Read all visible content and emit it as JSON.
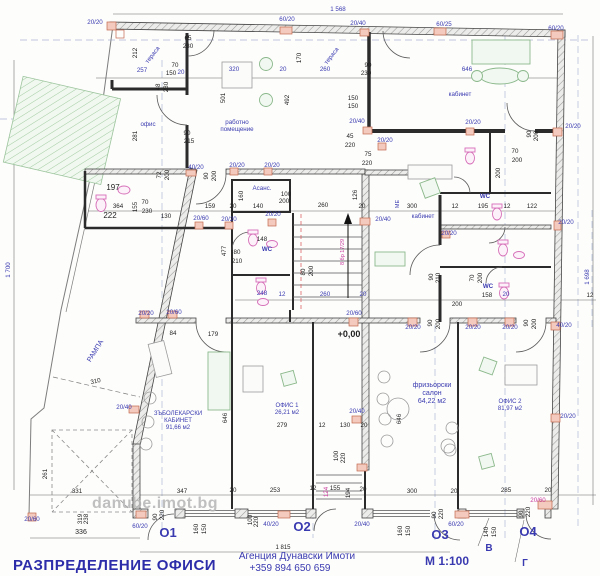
{
  "drawing": {
    "title": "РАЗПРЕДЕЛЕНИЕ ОФИСИ",
    "watermark": "danube.imot.bg",
    "agency": "Агенция Дунавски Имоти",
    "phone": "+359 894 650 659",
    "scale": "М 1:100",
    "level_mark": "+0,00",
    "stair_note": "8 бр 17/29",
    "overall_dims": {
      "top": "1 568",
      "left": "1 700",
      "right": "1 698",
      "bottom": "1 815"
    }
  },
  "axes": [
    "О1",
    "О2",
    "О3",
    "О4",
    "В",
    "Г"
  ],
  "rooms": [
    {
      "name": "тераса"
    },
    {
      "name": "офис"
    },
    {
      "name": "работно помещение"
    },
    {
      "name": "кабинет"
    },
    {
      "name": "Асанс."
    },
    {
      "name": "WC"
    },
    {
      "name": "РАМПА"
    },
    {
      "name": "ЗЪБОЛЕКАРСКИ КАБИНЕТ",
      "area": "91,66 м2"
    },
    {
      "name": "ОФИС 1",
      "area": "26,21 м2"
    },
    {
      "name": "фризьорски салон",
      "area": "64,22 м2"
    },
    {
      "name": "ОФИС 2",
      "area": "81,97 м2"
    }
  ],
  "labels": [
    {
      "t": "тераса",
      "x": 154,
      "y": 56,
      "c": "b",
      "r": -52,
      "n": "room-label-terrace-1"
    },
    {
      "t": "тераса",
      "x": 333,
      "y": 57,
      "c": "b",
      "r": -52,
      "n": "room-label-terrace-2"
    },
    {
      "t": "офис",
      "x": 148,
      "y": 126,
      "c": "b",
      "n": "room-label-office"
    },
    {
      "t": "работно",
      "x": 237,
      "y": 124,
      "c": "b",
      "n": "room-label-workroom"
    },
    {
      "t": "помещение",
      "x": 237,
      "y": 131,
      "c": "b"
    },
    {
      "t": "кабинет",
      "x": 460,
      "y": 96,
      "c": "b",
      "n": "room-label-cabinet-top"
    },
    {
      "t": "кабинет",
      "x": 423,
      "y": 218,
      "c": "b",
      "n": "room-label-cabinet-mid"
    },
    {
      "t": "Асанс.",
      "x": 262,
      "y": 190,
      "c": "b",
      "n": "room-label-elevator"
    },
    {
      "t": "WC",
      "x": 485,
      "y": 198,
      "c": "b",
      "b": 1,
      "n": "room-label-wc-1"
    },
    {
      "t": "WC",
      "x": 267,
      "y": 251,
      "c": "b",
      "b": 1,
      "n": "room-label-wc-2"
    },
    {
      "t": "WC",
      "x": 488,
      "y": 288,
      "c": "b",
      "b": 1,
      "n": "room-label-wc-3"
    },
    {
      "t": "МЕ",
      "x": 399,
      "y": 204,
      "c": "b",
      "r": -90,
      "s": 5.5
    },
    {
      "t": "РАМПА",
      "x": 97,
      "y": 352,
      "c": "b",
      "r": -58,
      "s": 7,
      "n": "room-label-ramp"
    },
    {
      "t": "ЗЪБОЛЕКАРСКИ",
      "x": 178,
      "y": 415,
      "c": "b",
      "s": 6,
      "n": "room-label-dental"
    },
    {
      "t": "КАБИНЕТ",
      "x": 178,
      "y": 422,
      "c": "b",
      "s": 6
    },
    {
      "t": "91,66 м2",
      "x": 178,
      "y": 429,
      "c": "b",
      "s": 6
    },
    {
      "t": "ОФИС 1",
      "x": 287,
      "y": 407,
      "c": "b",
      "s": 6,
      "n": "room-label-office1"
    },
    {
      "t": "26,21 м2",
      "x": 287,
      "y": 414,
      "c": "b",
      "s": 6
    },
    {
      "t": "фризьорски",
      "x": 432,
      "y": 387,
      "c": "b",
      "s": 7,
      "n": "room-label-salon"
    },
    {
      "t": "салон",
      "x": 432,
      "y": 395,
      "c": "b",
      "s": 7
    },
    {
      "t": "64,22 м2",
      "x": 432,
      "y": 403,
      "c": "b",
      "s": 7
    },
    {
      "t": "ОФИС 2",
      "x": 510,
      "y": 403,
      "c": "b",
      "s": 6,
      "n": "room-label-office2"
    },
    {
      "t": "81,97 м2",
      "x": 510,
      "y": 410,
      "c": "b",
      "s": 6
    },
    {
      "t": "О1",
      "x": 168,
      "y": 537,
      "c": "b",
      "s": 13,
      "b": 1,
      "n": "axis-label-O1"
    },
    {
      "t": "О2",
      "x": 302,
      "y": 531,
      "c": "b",
      "s": 13,
      "b": 1,
      "n": "axis-label-O2"
    },
    {
      "t": "О3",
      "x": 440,
      "y": 539,
      "c": "b",
      "s": 13,
      "b": 1,
      "n": "axis-label-O3"
    },
    {
      "t": "О4",
      "x": 528,
      "y": 536,
      "c": "b",
      "s": 13,
      "b": 1,
      "n": "axis-label-O4"
    },
    {
      "t": "В",
      "x": 489,
      "y": 551,
      "c": "b",
      "s": 10,
      "b": 1,
      "n": "axis-label-V"
    },
    {
      "t": "Г",
      "x": 525,
      "y": 566,
      "c": "b",
      "s": 10,
      "b": 1,
      "n": "axis-label-G"
    },
    {
      "t": "8 бр 17/29",
      "x": 344,
      "y": 252,
      "c": "p",
      "r": -90,
      "s": 5.5,
      "n": "stair-note"
    },
    {
      "t": "124",
      "x": 328,
      "y": 492,
      "c": "p",
      "r": -90
    },
    {
      "t": "20/60",
      "x": 538,
      "y": 502,
      "c": "p"
    },
    {
      "t": "20/20",
      "x": 95,
      "y": 24,
      "c": "b"
    },
    {
      "t": "60/20",
      "x": 287,
      "y": 21,
      "c": "b"
    },
    {
      "t": "20/40",
      "x": 358,
      "y": 25,
      "c": "b"
    },
    {
      "t": "60/25",
      "x": 444,
      "y": 26,
      "c": "b"
    },
    {
      "t": "60/20",
      "x": 556,
      "y": 30,
      "c": "b"
    },
    {
      "t": "257",
      "x": 142,
      "y": 72,
      "c": "b"
    },
    {
      "t": "20",
      "x": 181,
      "y": 74,
      "c": "b"
    },
    {
      "t": "320",
      "x": 234,
      "y": 71,
      "c": "b"
    },
    {
      "t": "20",
      "x": 283,
      "y": 71,
      "c": "b"
    },
    {
      "t": "260",
      "x": 325,
      "y": 71,
      "c": "b"
    },
    {
      "t": "646",
      "x": 467,
      "y": 71,
      "c": "b"
    },
    {
      "t": "40/20",
      "x": 196,
      "y": 169,
      "c": "b"
    },
    {
      "t": "20/20",
      "x": 237,
      "y": 167,
      "c": "b"
    },
    {
      "t": "20/20",
      "x": 272,
      "y": 167,
      "c": "b"
    },
    {
      "t": "20/40",
      "x": 357,
      "y": 123,
      "c": "b"
    },
    {
      "t": "20/20",
      "x": 473,
      "y": 124,
      "c": "b"
    },
    {
      "t": "20/20",
      "x": 573,
      "y": 128,
      "c": "b"
    },
    {
      "t": "20/20",
      "x": 385,
      "y": 142,
      "c": "b"
    },
    {
      "t": "20/20",
      "x": 273,
      "y": 216,
      "c": "b"
    },
    {
      "t": "20/60",
      "x": 201,
      "y": 220,
      "c": "b"
    },
    {
      "t": "20/20",
      "x": 229,
      "y": 221,
      "c": "b"
    },
    {
      "t": "20/40",
      "x": 383,
      "y": 221,
      "c": "b"
    },
    {
      "t": "20/20",
      "x": 449,
      "y": 235,
      "c": "b"
    },
    {
      "t": "20/20",
      "x": 566,
      "y": 224,
      "c": "b"
    },
    {
      "t": "248",
      "x": 262,
      "y": 295,
      "c": "b"
    },
    {
      "t": "12",
      "x": 282,
      "y": 296,
      "c": "b"
    },
    {
      "t": "260",
      "x": 325,
      "y": 296,
      "c": "b"
    },
    {
      "t": "20",
      "x": 363,
      "y": 296,
      "c": "b"
    },
    {
      "t": "20",
      "x": 506,
      "y": 296,
      "c": "b"
    },
    {
      "t": "20/60",
      "x": 354,
      "y": 315,
      "c": "b"
    },
    {
      "t": "20/20",
      "x": 146,
      "y": 315,
      "c": "b"
    },
    {
      "t": "20/60",
      "x": 174,
      "y": 314,
      "c": "b"
    },
    {
      "t": "20/40",
      "x": 124,
      "y": 409,
      "c": "b"
    },
    {
      "t": "20/20",
      "x": 413,
      "y": 329,
      "c": "b"
    },
    {
      "t": "20/20",
      "x": 473,
      "y": 329,
      "c": "b"
    },
    {
      "t": "20/20",
      "x": 510,
      "y": 329,
      "c": "b"
    },
    {
      "t": "40/20",
      "x": 564,
      "y": 327,
      "c": "b"
    },
    {
      "t": "20/40",
      "x": 357,
      "y": 413,
      "c": "b"
    },
    {
      "t": "20/20",
      "x": 568,
      "y": 418,
      "c": "b"
    },
    {
      "t": "20/60",
      "x": 32,
      "y": 521,
      "c": "b"
    },
    {
      "t": "60/20",
      "x": 140,
      "y": 528,
      "c": "b"
    },
    {
      "t": "40/20",
      "x": 271,
      "y": 526,
      "c": "b"
    },
    {
      "t": "20/40",
      "x": 362,
      "y": 526,
      "c": "b"
    },
    {
      "t": "60/20",
      "x": 456,
      "y": 526,
      "c": "b"
    },
    {
      "t": "212",
      "x": 137,
      "y": 53,
      "r": -90
    },
    {
      "t": "65",
      "x": 188,
      "y": 40
    },
    {
      "t": "230",
      "x": 188,
      "y": 48
    },
    {
      "t": "70",
      "x": 175,
      "y": 67
    },
    {
      "t": "150",
      "x": 171,
      "y": 75
    },
    {
      "t": "90",
      "x": 187,
      "y": 135
    },
    {
      "t": "215",
      "x": 189,
      "y": 143
    },
    {
      "t": "281",
      "x": 137,
      "y": 136,
      "r": -90
    },
    {
      "t": "48",
      "x": 160,
      "y": 87,
      "r": -90
    },
    {
      "t": "230",
      "x": 168,
      "y": 87,
      "r": -90
    },
    {
      "t": "501",
      "x": 225,
      "y": 98,
      "r": -90
    },
    {
      "t": "492",
      "x": 289,
      "y": 100,
      "r": -90
    },
    {
      "t": "170",
      "x": 301,
      "y": 58,
      "r": -90
    },
    {
      "t": "90",
      "x": 368,
      "y": 67
    },
    {
      "t": "230",
      "x": 366,
      "y": 75
    },
    {
      "t": "150",
      "x": 353,
      "y": 100
    },
    {
      "t": "150",
      "x": 353,
      "y": 108
    },
    {
      "t": "70",
      "x": 515,
      "y": 153
    },
    {
      "t": "200",
      "x": 517,
      "y": 162
    },
    {
      "t": "90",
      "x": 531,
      "y": 134,
      "r": -90
    },
    {
      "t": "200",
      "x": 538,
      "y": 136,
      "r": -90
    },
    {
      "t": "197",
      "x": 113,
      "y": 190,
      "s": 8
    },
    {
      "t": "222",
      "x": 110,
      "y": 218,
      "s": 8
    },
    {
      "t": "364",
      "x": 118,
      "y": 208
    },
    {
      "t": "155",
      "x": 137,
      "y": 207,
      "r": -90
    },
    {
      "t": "70",
      "x": 145,
      "y": 204
    },
    {
      "t": "230",
      "x": 147,
      "y": 213
    },
    {
      "t": "130",
      "x": 166,
      "y": 218
    },
    {
      "t": "72",
      "x": 161,
      "y": 175,
      "r": -90
    },
    {
      "t": "200",
      "x": 169,
      "y": 175,
      "r": -90
    },
    {
      "t": "90",
      "x": 208,
      "y": 176,
      "r": -90
    },
    {
      "t": "200",
      "x": 216,
      "y": 176,
      "r": -90
    },
    {
      "t": "159",
      "x": 210,
      "y": 208
    },
    {
      "t": "20",
      "x": 233,
      "y": 208
    },
    {
      "t": "140",
      "x": 258,
      "y": 208
    },
    {
      "t": "100",
      "x": 286,
      "y": 196
    },
    {
      "t": "200",
      "x": 284,
      "y": 203
    },
    {
      "t": "160",
      "x": 243,
      "y": 196,
      "r": -90
    },
    {
      "t": "126",
      "x": 357,
      "y": 195,
      "r": -90
    },
    {
      "t": "260",
      "x": 323,
      "y": 207
    },
    {
      "t": "20",
      "x": 362,
      "y": 208
    },
    {
      "t": "300",
      "x": 412,
      "y": 208
    },
    {
      "t": "12",
      "x": 455,
      "y": 208
    },
    {
      "t": "195",
      "x": 483,
      "y": 208
    },
    {
      "t": "12",
      "x": 507,
      "y": 208
    },
    {
      "t": "122",
      "x": 532,
      "y": 208
    },
    {
      "t": "148",
      "x": 262,
      "y": 241
    },
    {
      "t": "80",
      "x": 237,
      "y": 254
    },
    {
      "t": "210",
      "x": 237,
      "y": 263
    },
    {
      "t": "477",
      "x": 226,
      "y": 251,
      "r": -90
    },
    {
      "t": "80",
      "x": 305,
      "y": 272,
      "r": -90
    },
    {
      "t": "200",
      "x": 313,
      "y": 271,
      "r": -90
    },
    {
      "t": "90",
      "x": 433,
      "y": 277,
      "r": -90
    },
    {
      "t": "210",
      "x": 440,
      "y": 278,
      "r": -90
    },
    {
      "t": "70",
      "x": 474,
      "y": 278,
      "r": -90
    },
    {
      "t": "200",
      "x": 482,
      "y": 278,
      "r": -90
    },
    {
      "t": "158",
      "x": 487,
      "y": 297
    },
    {
      "t": "12",
      "x": 590,
      "y": 297
    },
    {
      "t": "200",
      "x": 500,
      "y": 173,
      "r": -90
    },
    {
      "t": "90",
      "x": 432,
      "y": 323,
      "r": -90
    },
    {
      "t": "200",
      "x": 440,
      "y": 324,
      "r": -90
    },
    {
      "t": "90",
      "x": 528,
      "y": 323,
      "r": -90
    },
    {
      "t": "200",
      "x": 536,
      "y": 324,
      "r": -90
    },
    {
      "t": "200",
      "x": 457,
      "y": 306
    },
    {
      "t": "84",
      "x": 173,
      "y": 335
    },
    {
      "t": "179",
      "x": 213,
      "y": 336
    },
    {
      "t": "310",
      "x": 96,
      "y": 383,
      "r": -12
    },
    {
      "t": "261",
      "x": 47,
      "y": 474,
      "r": -90
    },
    {
      "t": "331",
      "x": 77,
      "y": 493
    },
    {
      "t": "347",
      "x": 182,
      "y": 493
    },
    {
      "t": "20",
      "x": 233,
      "y": 492
    },
    {
      "t": "253",
      "x": 275,
      "y": 492
    },
    {
      "t": "336",
      "x": 81,
      "y": 534,
      "s": 7
    },
    {
      "t": "319",
      "x": 82,
      "y": 519,
      "r": -90
    },
    {
      "t": "238",
      "x": 88,
      "y": 519,
      "r": -90
    },
    {
      "t": "90",
      "x": 157,
      "y": 517,
      "r": -90
    },
    {
      "t": "220",
      "x": 164,
      "y": 515,
      "r": -90
    },
    {
      "t": "160",
      "x": 198,
      "y": 529,
      "r": -90
    },
    {
      "t": "150",
      "x": 206,
      "y": 529,
      "r": -90
    },
    {
      "t": "100",
      "x": 252,
      "y": 520,
      "r": -90
    },
    {
      "t": "220",
      "x": 258,
      "y": 522,
      "r": -90
    },
    {
      "t": "279",
      "x": 282,
      "y": 427
    },
    {
      "t": "12",
      "x": 322,
      "y": 427
    },
    {
      "t": "130",
      "x": 345,
      "y": 427
    },
    {
      "t": "20",
      "x": 364,
      "y": 427
    },
    {
      "t": "100",
      "x": 338,
      "y": 456,
      "r": -90
    },
    {
      "t": "220",
      "x": 345,
      "y": 458,
      "r": -90
    },
    {
      "t": "155",
      "x": 335,
      "y": 490
    },
    {
      "t": "12",
      "x": 313,
      "y": 490
    },
    {
      "t": "194",
      "x": 350,
      "y": 493,
      "r": -90
    },
    {
      "t": "20",
      "x": 363,
      "y": 491
    },
    {
      "t": "300",
      "x": 412,
      "y": 493
    },
    {
      "t": "20",
      "x": 454,
      "y": 493
    },
    {
      "t": "285",
      "x": 506,
      "y": 492
    },
    {
      "t": "20",
      "x": 548,
      "y": 492
    },
    {
      "t": "90",
      "x": 436,
      "y": 515,
      "r": -90
    },
    {
      "t": "220",
      "x": 443,
      "y": 514,
      "r": -90
    },
    {
      "t": "160",
      "x": 402,
      "y": 531,
      "r": -90
    },
    {
      "t": "150",
      "x": 410,
      "y": 531,
      "r": -90
    },
    {
      "t": "140",
      "x": 488,
      "y": 532,
      "r": -90
    },
    {
      "t": "150",
      "x": 496,
      "y": 532,
      "r": -90
    },
    {
      "t": "90",
      "x": 523,
      "y": 514,
      "r": -90
    },
    {
      "t": "220",
      "x": 530,
      "y": 512,
      "r": -90
    },
    {
      "t": "45",
      "x": 350,
      "y": 138
    },
    {
      "t": "220",
      "x": 350,
      "y": 147
    },
    {
      "t": "75",
      "x": 368,
      "y": 156
    },
    {
      "t": "220",
      "x": 367,
      "y": 165
    },
    {
      "t": "646",
      "x": 401,
      "y": 419,
      "r": -90
    },
    {
      "t": "646",
      "x": 227,
      "y": 418,
      "r": -90
    },
    {
      "t": "+0,00",
      "x": 349,
      "y": 337,
      "s": 9,
      "b": 1,
      "n": "level-mark"
    }
  ]
}
